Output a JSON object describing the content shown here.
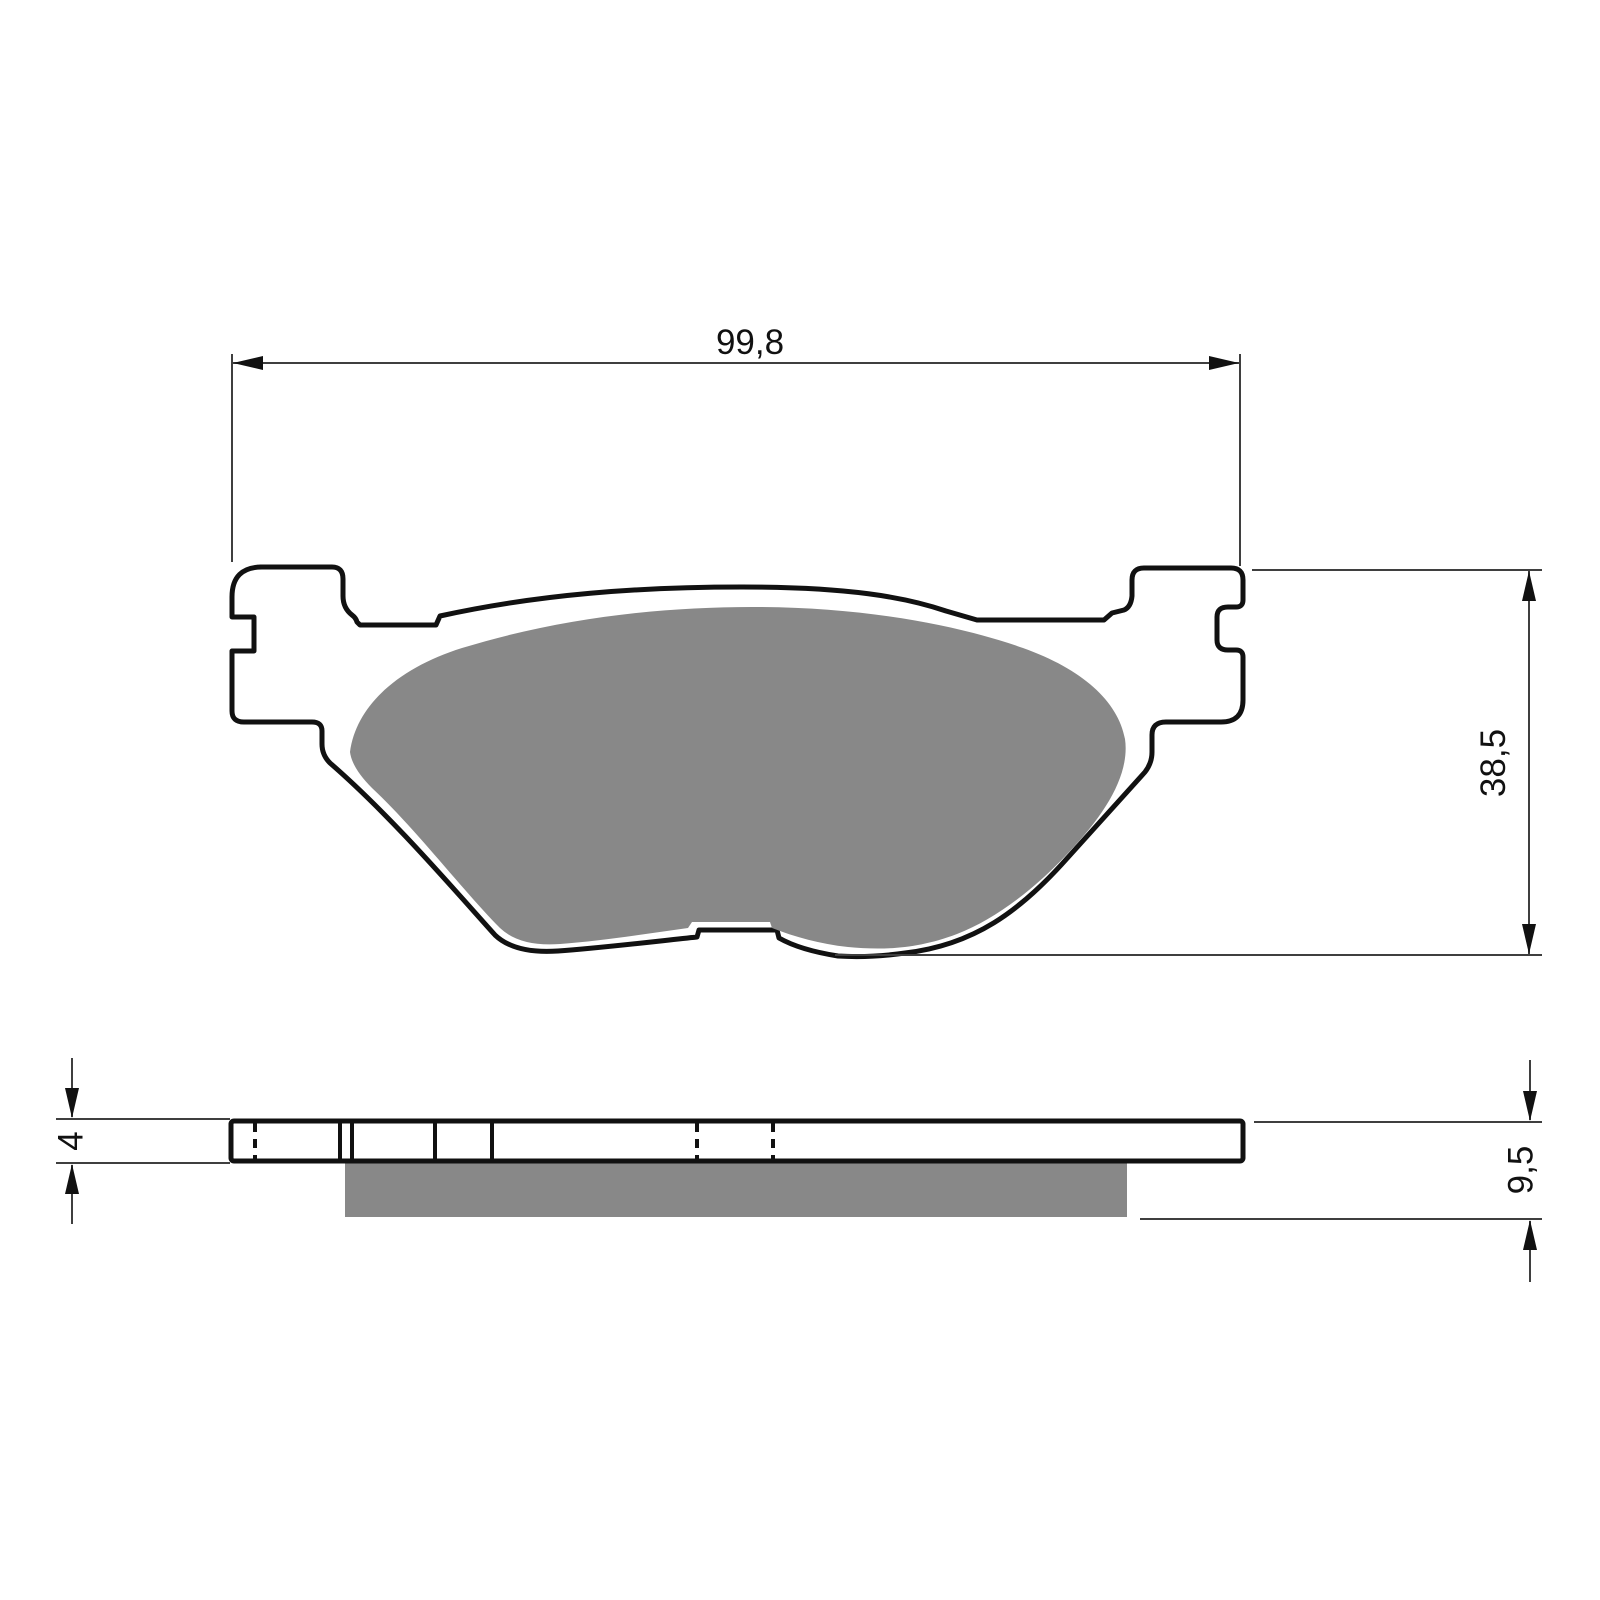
{
  "drawing": {
    "part": "brake-pad",
    "type": "technical-dimension-drawing",
    "dimensions": {
      "overall_width": "99,8",
      "overall_height": "38,5",
      "backplate_thickness": "4",
      "total_thickness": "9,5"
    },
    "colors": {
      "outline": "#111111",
      "friction_material": "#888888",
      "dimension_lines": "#3f3f3f",
      "background": "#ffffff"
    }
  }
}
